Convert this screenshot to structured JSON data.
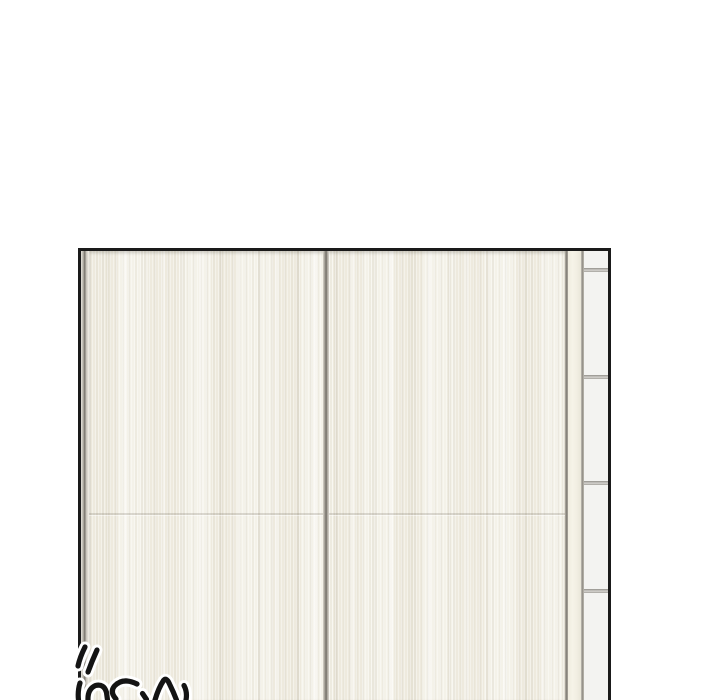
{
  "scene": {
    "description": "webtoon comic panel showing closed cream sliding wardrobe doors beside a tiled wall strip",
    "background_color": "#ffffff",
    "panel_border_color": "#1a1a1a",
    "door_color": "#f2efe4",
    "frame_gray_color": "#7d796f",
    "side_casing_color": "#f2efe3",
    "tile_color": "#f3f3f1",
    "tile_line_color": "#a3a19c"
  },
  "sfx": {
    "label": "partially cropped handwritten sound-effect lettering",
    "ink_color": "#141414",
    "outline_color": "#ffffff",
    "strokes": [
      "M85 647 Q80 657 78 666",
      "M97 650 Q92 661 88 672",
      "M80 683 Q77.5 691 78.5 700",
      "M88 700 Q87.5 689 95.5 685.5 Q104 683.5 106.5 692.5 L107.5 700",
      "M137 684 Q123 677 114.5 686 Q109.5 692 116 699",
      "M142.5 693.5 L146.5 699.5",
      "M155 700 Q158.5 688 163.5 680.5 Q166.5 677 169.5 684 Q173.5 692 176.5 700",
      "M184 685.5 Q187.5 692 186 700"
    ]
  }
}
